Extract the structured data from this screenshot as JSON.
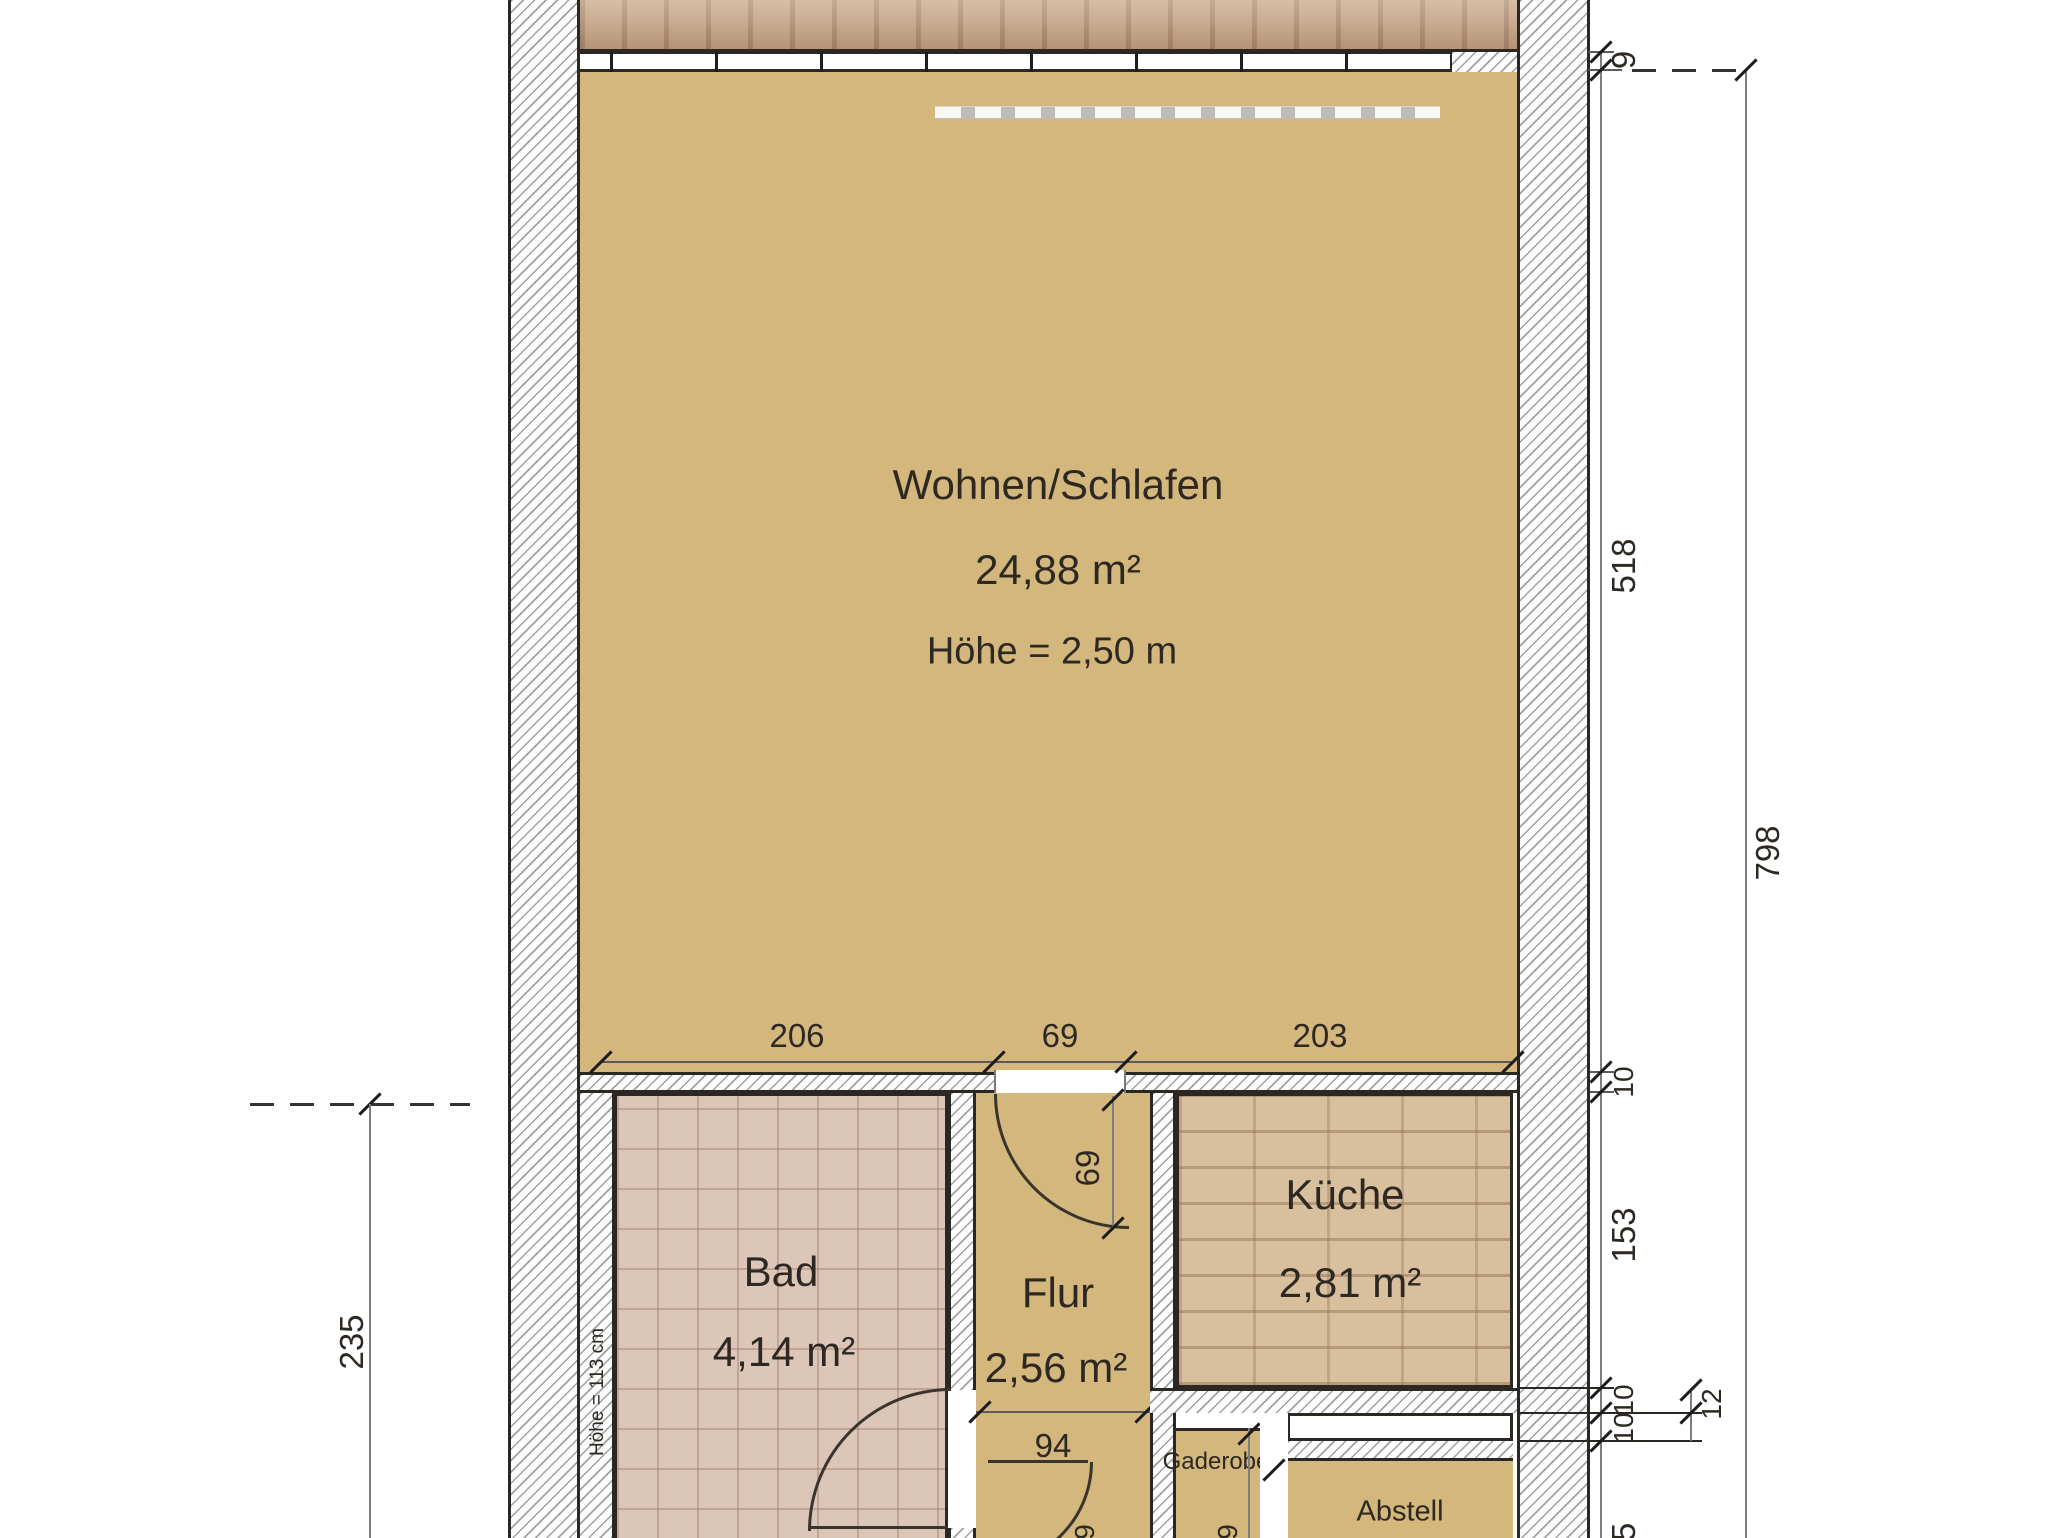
{
  "rooms": {
    "wohnen": {
      "name": "Wohnen/Schlafen",
      "area": "24,88 m²",
      "note": "Höhe = 2,50 m"
    },
    "bad": {
      "name": "Bad",
      "area": "4,14 m²",
      "wall_note": "Höhe = 113 cm"
    },
    "flur": {
      "name": "Flur",
      "area": "2,56 m²"
    },
    "kueche": {
      "name": "Küche",
      "area": "2,81 m²"
    },
    "gaderobe": {
      "name": "Gaderobe"
    },
    "abstell": {
      "name": "Abstell"
    }
  },
  "dims": {
    "top": [
      "206",
      "69",
      "203"
    ],
    "right_segments": [
      "9",
      "518",
      "10",
      "153",
      "10",
      "10"
    ],
    "right_partial": "5",
    "right_offset": "12",
    "right_total": "798",
    "left": "235",
    "flur_door": "69",
    "flur_width": "94",
    "bottom_partial_flur": "9",
    "bottom_partial_gaderobe": "9"
  },
  "colors": {
    "floor_tan": "#d4b77c",
    "bad_tile": "#dcc6b8",
    "kueche_brick": "#d8bf9e",
    "terrace_wood": "#c9a585",
    "line_dark": "#2b2722"
  }
}
